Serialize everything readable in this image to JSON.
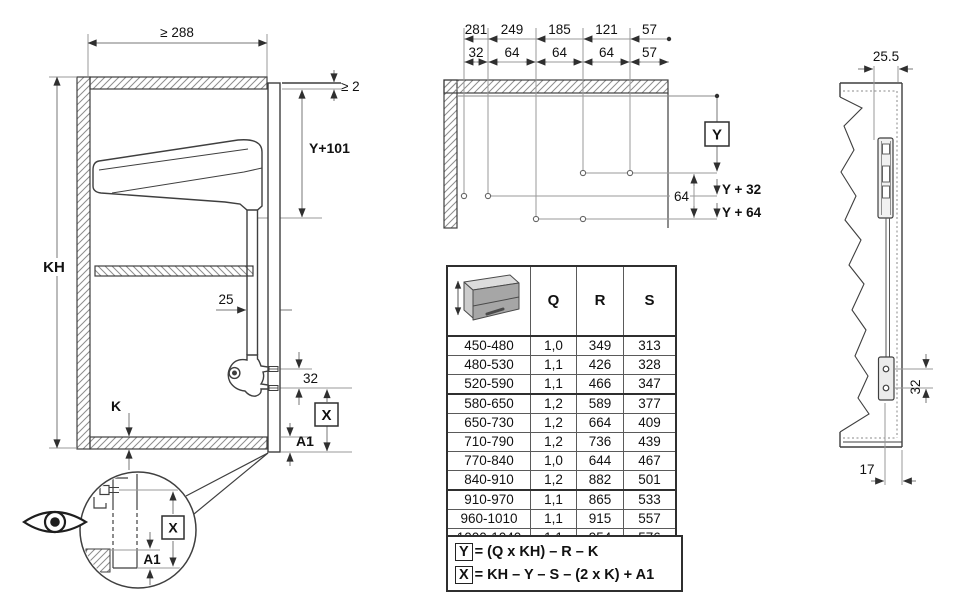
{
  "left_view": {
    "width_min": "≥ 288",
    "top_gap": "≥ 2",
    "arm_height": "Y+101",
    "cabinet_height": "KH",
    "arm_clearance": "25",
    "screw_spacing": "32",
    "panel_thickness": "K",
    "x": "X",
    "a1": "A1",
    "detail": {
      "x": "X",
      "a1": "A1"
    }
  },
  "drill_pattern": {
    "row1": [
      "281",
      "249",
      "185",
      "121",
      "57"
    ],
    "row2": [
      "32",
      "64",
      "64",
      "64",
      "57"
    ],
    "y": "Y",
    "y_plus_32": "Y + 32",
    "y_plus_64": "Y + 64",
    "row_spacing": "64"
  },
  "spec_table": {
    "col_q": "Q",
    "col_r": "R",
    "col_s": "S",
    "rows": [
      {
        "kh": "450-480",
        "q": "1,0",
        "r": "349",
        "s": "313"
      },
      {
        "kh": "480-530",
        "q": "1,1",
        "r": "426",
        "s": "328"
      },
      {
        "kh": "520-590",
        "q": "1,1",
        "r": "466",
        "s": "347"
      },
      {
        "kh": "580-650",
        "q": "1,2",
        "r": "589",
        "s": "377"
      },
      {
        "kh": "650-730",
        "q": "1,2",
        "r": "664",
        "s": "409"
      },
      {
        "kh": "710-790",
        "q": "1,2",
        "r": "736",
        "s": "439"
      },
      {
        "kh": "770-840",
        "q": "1,0",
        "r": "644",
        "s": "467"
      },
      {
        "kh": "840-910",
        "q": "1,2",
        "r": "882",
        "s": "501"
      },
      {
        "kh": "910-970",
        "q": "1,1",
        "r": "865",
        "s": "533"
      },
      {
        "kh": "960-1010",
        "q": "1,1",
        "r": "915",
        "s": "557"
      },
      {
        "kh": "1000-1040",
        "q": "1,1",
        "r": "954",
        "s": "576"
      }
    ],
    "formula_y_box": "Y",
    "formula_y": "= (Q x KH) – R – K",
    "formula_x_box": "X",
    "formula_x": "= KH – Y – S – (2 x K) + A1"
  },
  "right_view": {
    "front_gap": "25.5",
    "screw_spacing": "32",
    "bottom_offset": "17"
  },
  "colors": {
    "line": "#3f3f3f",
    "dim": "#9a9a9a",
    "accent": "#2f2f2f"
  }
}
